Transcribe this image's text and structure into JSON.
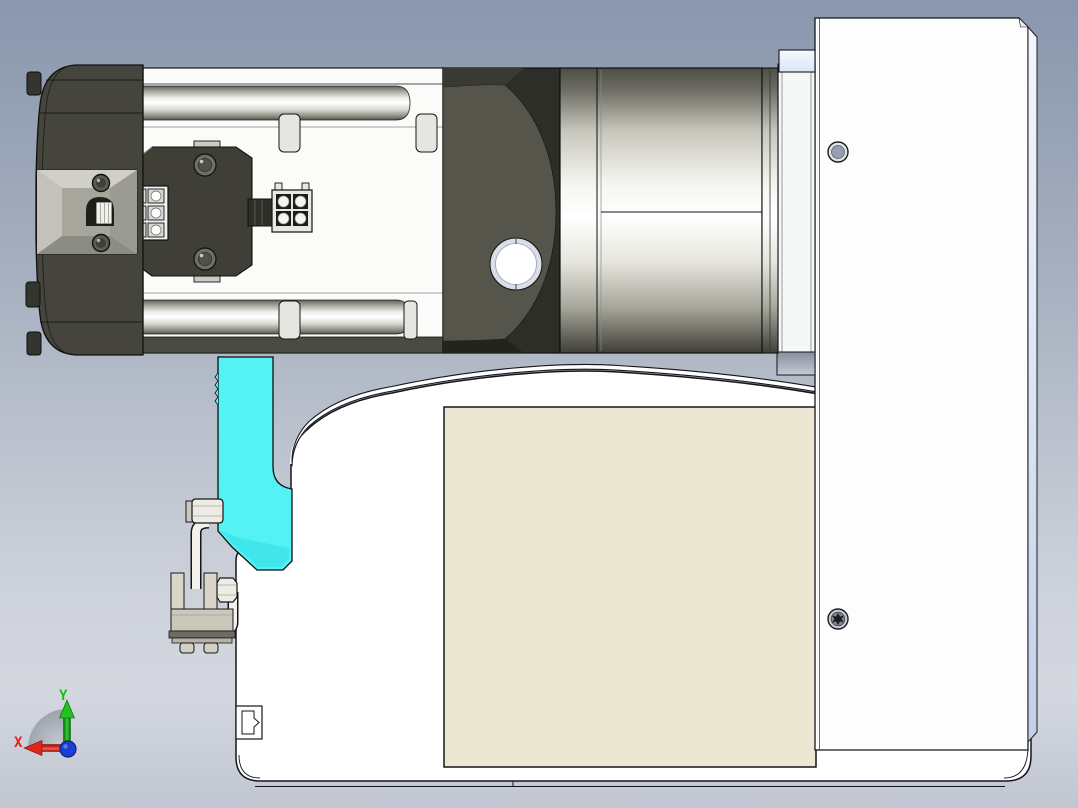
{
  "viewer": {
    "type": "cad-3d-viewer",
    "view": "side-elevation",
    "selection_highlight": "#55f2f5"
  },
  "axis_triad": {
    "x_label": "X",
    "y_label": "Y",
    "x_color": "#e02015",
    "y_color": "#16c316",
    "origin_color": "#1b3fd6"
  },
  "palette": {
    "background_top": "#8a97ad",
    "background_bottom": "#c1c6d2",
    "cover_plate_beige": "#ece7d3",
    "metal_white": "#fdfdfd",
    "metal_dark": "#45453e",
    "panel_edge_blue": "#dde5f4",
    "outline": "#15161a"
  },
  "components": [
    {
      "id": "machine-body",
      "label": "machine body",
      "selected": false
    },
    {
      "id": "cover-plate",
      "label": "cover plate",
      "selected": false
    },
    {
      "id": "side-panel",
      "label": "side panel",
      "selected": false
    },
    {
      "id": "mounting-flange",
      "label": "mounting flange",
      "selected": false
    },
    {
      "id": "highlighted-part",
      "label": "highlighted part",
      "selected": true
    },
    {
      "id": "servo-motor",
      "label": "servo motor",
      "selected": false
    },
    {
      "id": "gearbox",
      "label": "gearbox",
      "selected": false
    },
    {
      "id": "sensor-bracket",
      "label": "sensor bracket",
      "selected": false
    }
  ]
}
